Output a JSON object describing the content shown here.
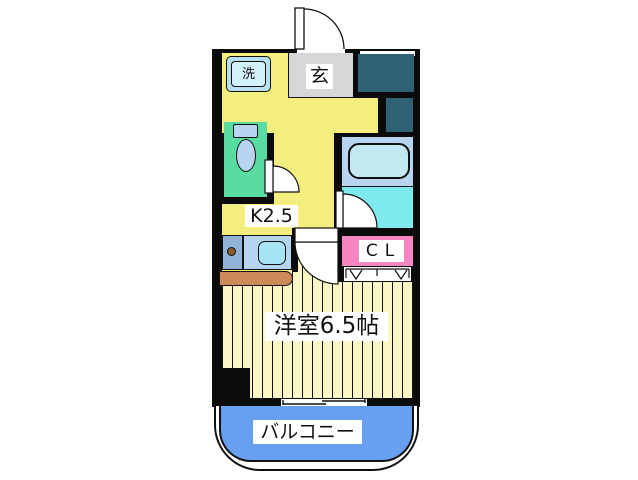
{
  "floorplan": {
    "rooms": {
      "kitchen": {
        "label": "K2.5"
      },
      "main_room": {
        "label": "洋室6.5帖"
      },
      "entrance": {
        "label": "玄"
      },
      "washer": {
        "label": "洗"
      },
      "closet": {
        "label": "CL"
      },
      "balcony": {
        "label": "バルコニー"
      }
    },
    "colors": {
      "wall": "#0b0b0b",
      "kitchen_floor": "#f4ee7f",
      "room_floor": "#fcf6c5",
      "toilet_floor": "#58dca1",
      "bath_upper": "#b7d5f1",
      "bathtub": "#c4e8f1",
      "bath_lower": "#7fe9f0",
      "closet_fill": "#f785c2",
      "balcony_fill": "#68a0f1",
      "entrance_floor": "#d7d7d7",
      "service_shaft": "#2f6274",
      "counter_left": "#90b3d7",
      "counter_right": "#b7d5f1",
      "sink": "#a6e3f3",
      "counter_ledge": "#cd8a58",
      "burner_knob": "#8b5a2b",
      "washer_box_outer": "#b9e0ef",
      "washer_box_inner": "#d3f1fa"
    }
  }
}
